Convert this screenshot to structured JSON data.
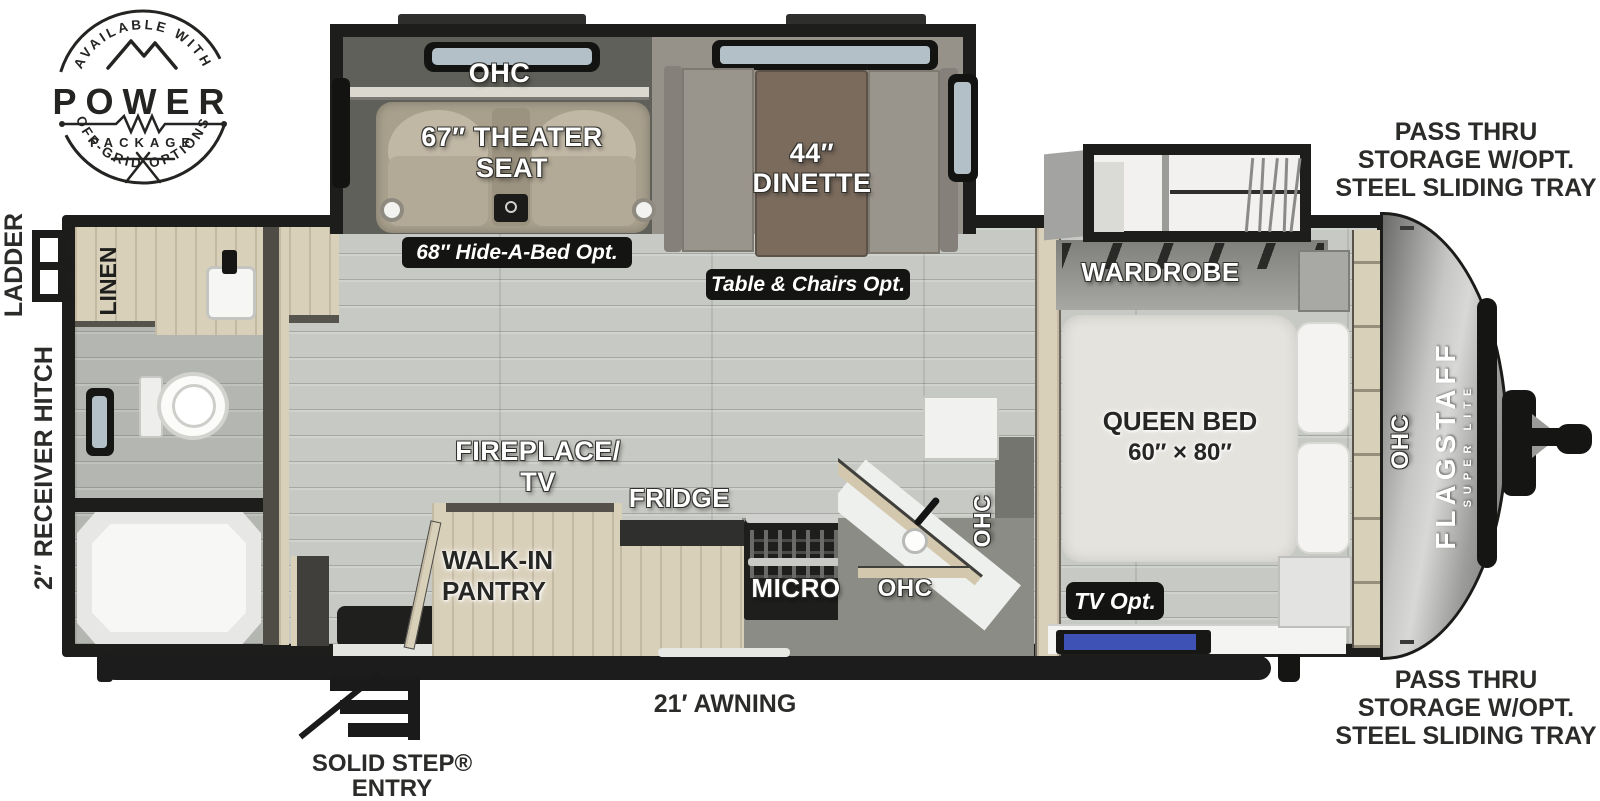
{
  "badge_logo": {
    "arc_top": "AVAILABLE WITH",
    "title": "POWER",
    "subtitle": "PACKAGE",
    "arc_bottom": "OFF-GRID OPTIONS"
  },
  "exterior": {
    "ladder": "LADDER",
    "receiver_hitch": "2″ RECEIVER HITCH",
    "awning": "21′ AWNING",
    "entry_line1": "SOLID STEP®",
    "entry_line2": "ENTRY",
    "pass_thru_top": {
      "line1": "PASS THRU",
      "line2": "STORAGE W/OPT.",
      "line3": "STEEL SLIDING TRAY"
    },
    "pass_thru_bottom": {
      "line1": "PASS THRU",
      "line2": "STORAGE W/OPT.",
      "line3": "STEEL SLIDING TRAY"
    }
  },
  "living_area": {
    "ohc_top": "OHC",
    "theater_line1": "67″ THEATER",
    "theater_line2": "SEAT",
    "hide_a_bed_badge": "68″ Hide-A-Bed Opt.",
    "dinette_line1": "44″",
    "dinette_line2": "DINETTE",
    "table_chairs_badge": "Table & Chairs Opt."
  },
  "kitchen": {
    "fireplace_line1": "FIREPLACE/",
    "fireplace_line2": "TV",
    "fridge": "FRIDGE",
    "pantry_line1": "WALK-IN",
    "pantry_line2": "PANTRY",
    "micro": "MICRO",
    "ohc": "OHC",
    "ohc_side": "OHC"
  },
  "bedroom": {
    "wardrobe": "WARDROBE",
    "bed_line1": "QUEEN BED",
    "bed_line2": "60″ × 80″",
    "tv_badge": "TV Opt.",
    "ohc_front": "OHC"
  },
  "bathroom": {
    "linen": "LINEN"
  },
  "brand": {
    "name": "FLAGSTAFF",
    "tagline": "SUPER LITE"
  },
  "colors": {
    "wall": "#1d1d1b",
    "floor": "#c7c9c4",
    "badge": "#141412",
    "wood": "#d9d0ba",
    "counter": "#eef0ee",
    "cap_silver": "#b5b5b3",
    "tv_screen": "#3d52b4",
    "glass": "#b3c0c8"
  }
}
